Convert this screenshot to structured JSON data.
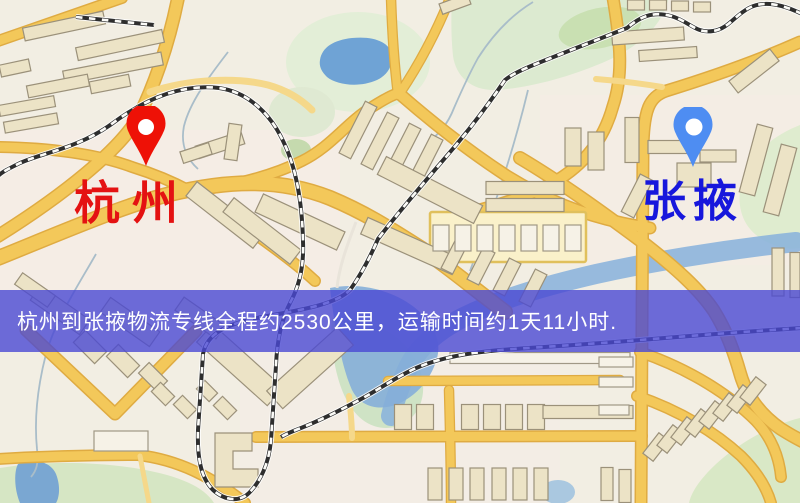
{
  "screen": {
    "width": 800,
    "height": 503
  },
  "markers": {
    "origin": {
      "label": "杭州",
      "pin_color": "#ee1106",
      "label_color": "#e41212"
    },
    "destination": {
      "label": "张掖",
      "pin_color": "#4e8df2",
      "label_color": "#1717dc"
    }
  },
  "banner": {
    "text": "杭州到张掖物流专线全程约2530公里，运输时间约1天11小时.",
    "background": "#4a48d3",
    "text_color": "#ffffff"
  },
  "map_palette": {
    "background": "#f2eee3",
    "road": "#f3c85a",
    "road_minor": "#f5d88a",
    "building": "#ece3c6",
    "green_area": "#d9e8c8",
    "water": "#76a5d4",
    "railway": "#2e2e2e"
  }
}
